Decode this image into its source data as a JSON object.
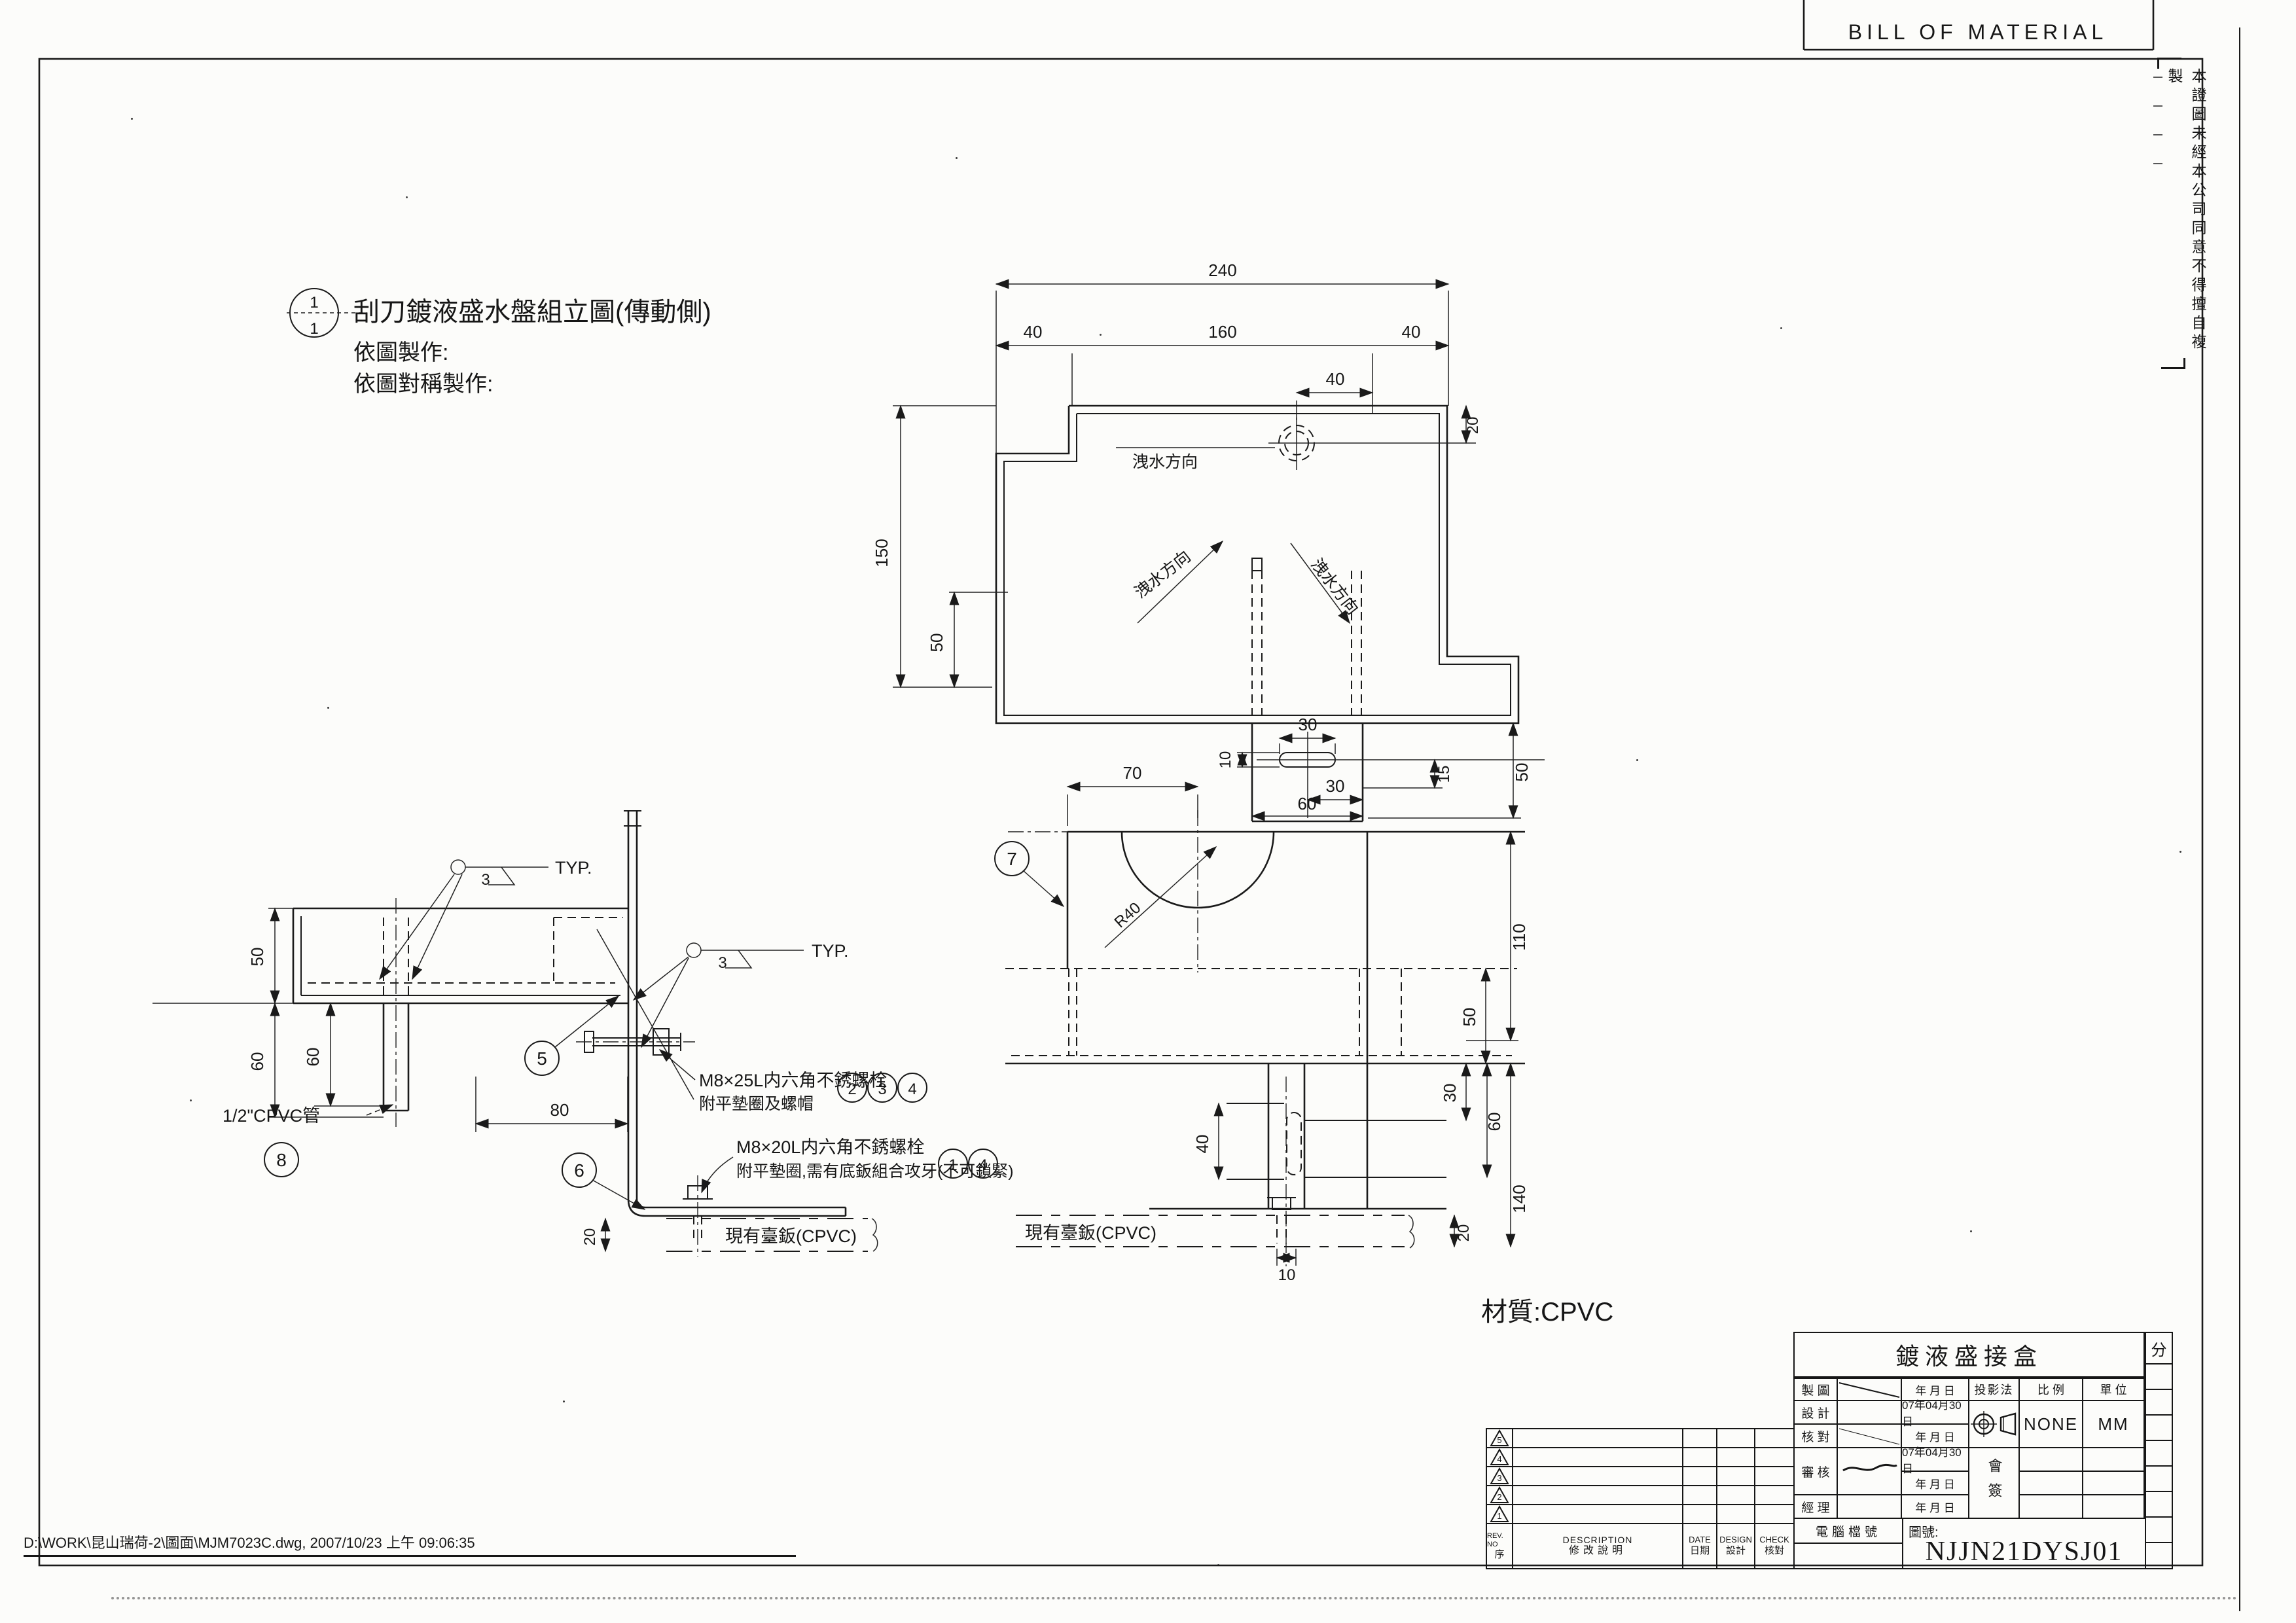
{
  "page": {
    "bom_title": "BILL OF MATERIAL",
    "disclaimer": "本證圖未經本公司同意不得擅自複製",
    "file_path": "D:\\WORK\\昆山瑞荷-2\\圖面\\MJM7023C.dwg, 2007/10/23 上午 09:06:35",
    "material_note": "材質:CPVC"
  },
  "assembly_note": {
    "balloon_top": "1",
    "balloon_bottom": "1",
    "title": "刮刀鍍液盛水盤組立圖(傳動側)",
    "line1": "依圖製作:",
    "line2": "依圖對稱製作:"
  },
  "plan": {
    "overall": "240",
    "seg_left": "40",
    "seg_mid": "160",
    "seg_right": "40",
    "hole_offset": "40",
    "hole_top": "20",
    "height": "150",
    "apron": "50",
    "drain_label_1": "洩水方向",
    "drain_label_2": "洩水方向",
    "drain_label_3": "洩水方向",
    "tab_slot_w": "30",
    "tab_slot_h": "10",
    "tab_step": "15",
    "tab_height": "50",
    "tab_offset": "30",
    "tab_width": "60"
  },
  "side": {
    "tray_depth": "50",
    "drop_outer": "60",
    "drop_inner": "60",
    "weld_size_1": "3",
    "weld_typ_1": "TYP.",
    "weld_size_2": "3",
    "weld_typ_2": "TYP.",
    "pipe_label": "1/2\"CPVC管",
    "balloon_5": "5",
    "balloon_6": "6",
    "balloon_8": "8",
    "span": "80",
    "base_label": "現有臺鈑(CPVC)",
    "base_thk": "20"
  },
  "bolt_note_1": {
    "line1": "M8×25L内六角不銹螺栓",
    "line2": "附平墊圈及螺帽",
    "b1": "2",
    "b2": "3",
    "b3": "4"
  },
  "bolt_note_2": {
    "line1": "M8×20L内六角不銹螺栓",
    "line2": "附平墊圈,需有底鈑組合攻牙(不可鎖緊)",
    "b1": "1",
    "b2": "4"
  },
  "section": {
    "balloon_7": "7",
    "width_70": "70",
    "radius": "R40",
    "h110": "110",
    "h50": "50",
    "h30": "30",
    "h60": "60",
    "h140": "140",
    "w40": "40",
    "w10": "10",
    "base_label": "現有臺鈑(CPVC)",
    "base_thk": "20"
  },
  "title_block": {
    "part_title": "鍍液盛接盒",
    "class_label": "分",
    "row_labels": [
      "製 圖",
      "設 計",
      "核 對",
      "審 核",
      "經 理"
    ],
    "dates": [
      "年  月  日",
      "07年04月30日",
      "年  月  日",
      "07年04月30日",
      "年  月  日",
      "年  月  日"
    ],
    "projection_label": "投影法",
    "scale_label": "比  例",
    "scale_value": "NONE",
    "unit_label": "單  位",
    "unit_value": "MM",
    "countersign": "會簽",
    "file_no_label": "電腦檔號",
    "dwg_no_label": "圖號:",
    "dwg_no": "NJJN21DYSJ01"
  },
  "rev_table": {
    "marks": [
      "5",
      "4",
      "3",
      "2",
      "1"
    ],
    "h_rev_en": "REV. NO",
    "h_rev_cn": "序",
    "h_desc_en": "DESCRIPTION",
    "h_desc_cn": "修改說明",
    "h_date_en": "DATE",
    "h_date_cn": "日期",
    "h_design_en": "DESIGN",
    "h_design_cn": "設計",
    "h_check_en": "CHECK",
    "h_check_cn": "核對"
  }
}
